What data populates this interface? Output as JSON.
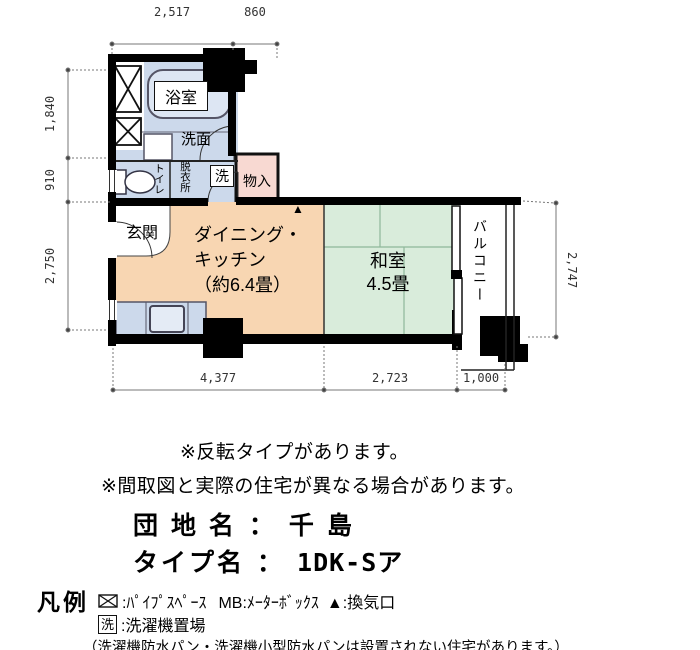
{
  "plan": {
    "dims": {
      "top1": "2,517",
      "top2": "860",
      "left1": "1,840",
      "left2": "910",
      "left3": "2,750",
      "right1": "2,747",
      "bottom1": "4,377",
      "bottom2": "2,723",
      "bottom3": "1,000"
    },
    "rooms": {
      "bath": "浴室",
      "washroom": "洗面",
      "toilet": "トイレ",
      "dressing": "脱衣所",
      "laundry_mark": "洗",
      "storage": "物入",
      "entrance": "玄関",
      "dk1": "ダイニング・",
      "dk2": "キッチン",
      "dk3": "（約6.4畳）",
      "washitsu1": "和室",
      "washitsu2": "4.5畳",
      "balcony": "バルコニー",
      "vent_mark": "▲"
    }
  },
  "notes": {
    "note1": "※反転タイプがあります。",
    "note2": "※間取図と実際の住宅が異なる場合があります。"
  },
  "title": {
    "estate_label": "団 地 名",
    "separator": "：",
    "estate_value": "千 島",
    "type_label": "タイプ名",
    "type_value": "1DK-Sア"
  },
  "legend": {
    "heading": "凡例",
    "pipe_space": ":ﾊﾟｲﾌﾟｽﾍﾟｰｽ",
    "meter_box": "MB:ﾒｰﾀｰﾎﾞｯｸｽ",
    "vent": "▲:換気口",
    "laundry_mark": "洗",
    "laundry": ":洗濯機置場",
    "note": "（洗濯機防水パン・洗濯機小型防水パンは設置されない住宅があります。）"
  },
  "colors": {
    "room_blue": "#ccd9eb",
    "room_orange": "#f8d6b2",
    "room_green": "#d9ecdb",
    "room_pink": "#f8d9d2",
    "wall": "#000000",
    "dimension": "#666666"
  }
}
